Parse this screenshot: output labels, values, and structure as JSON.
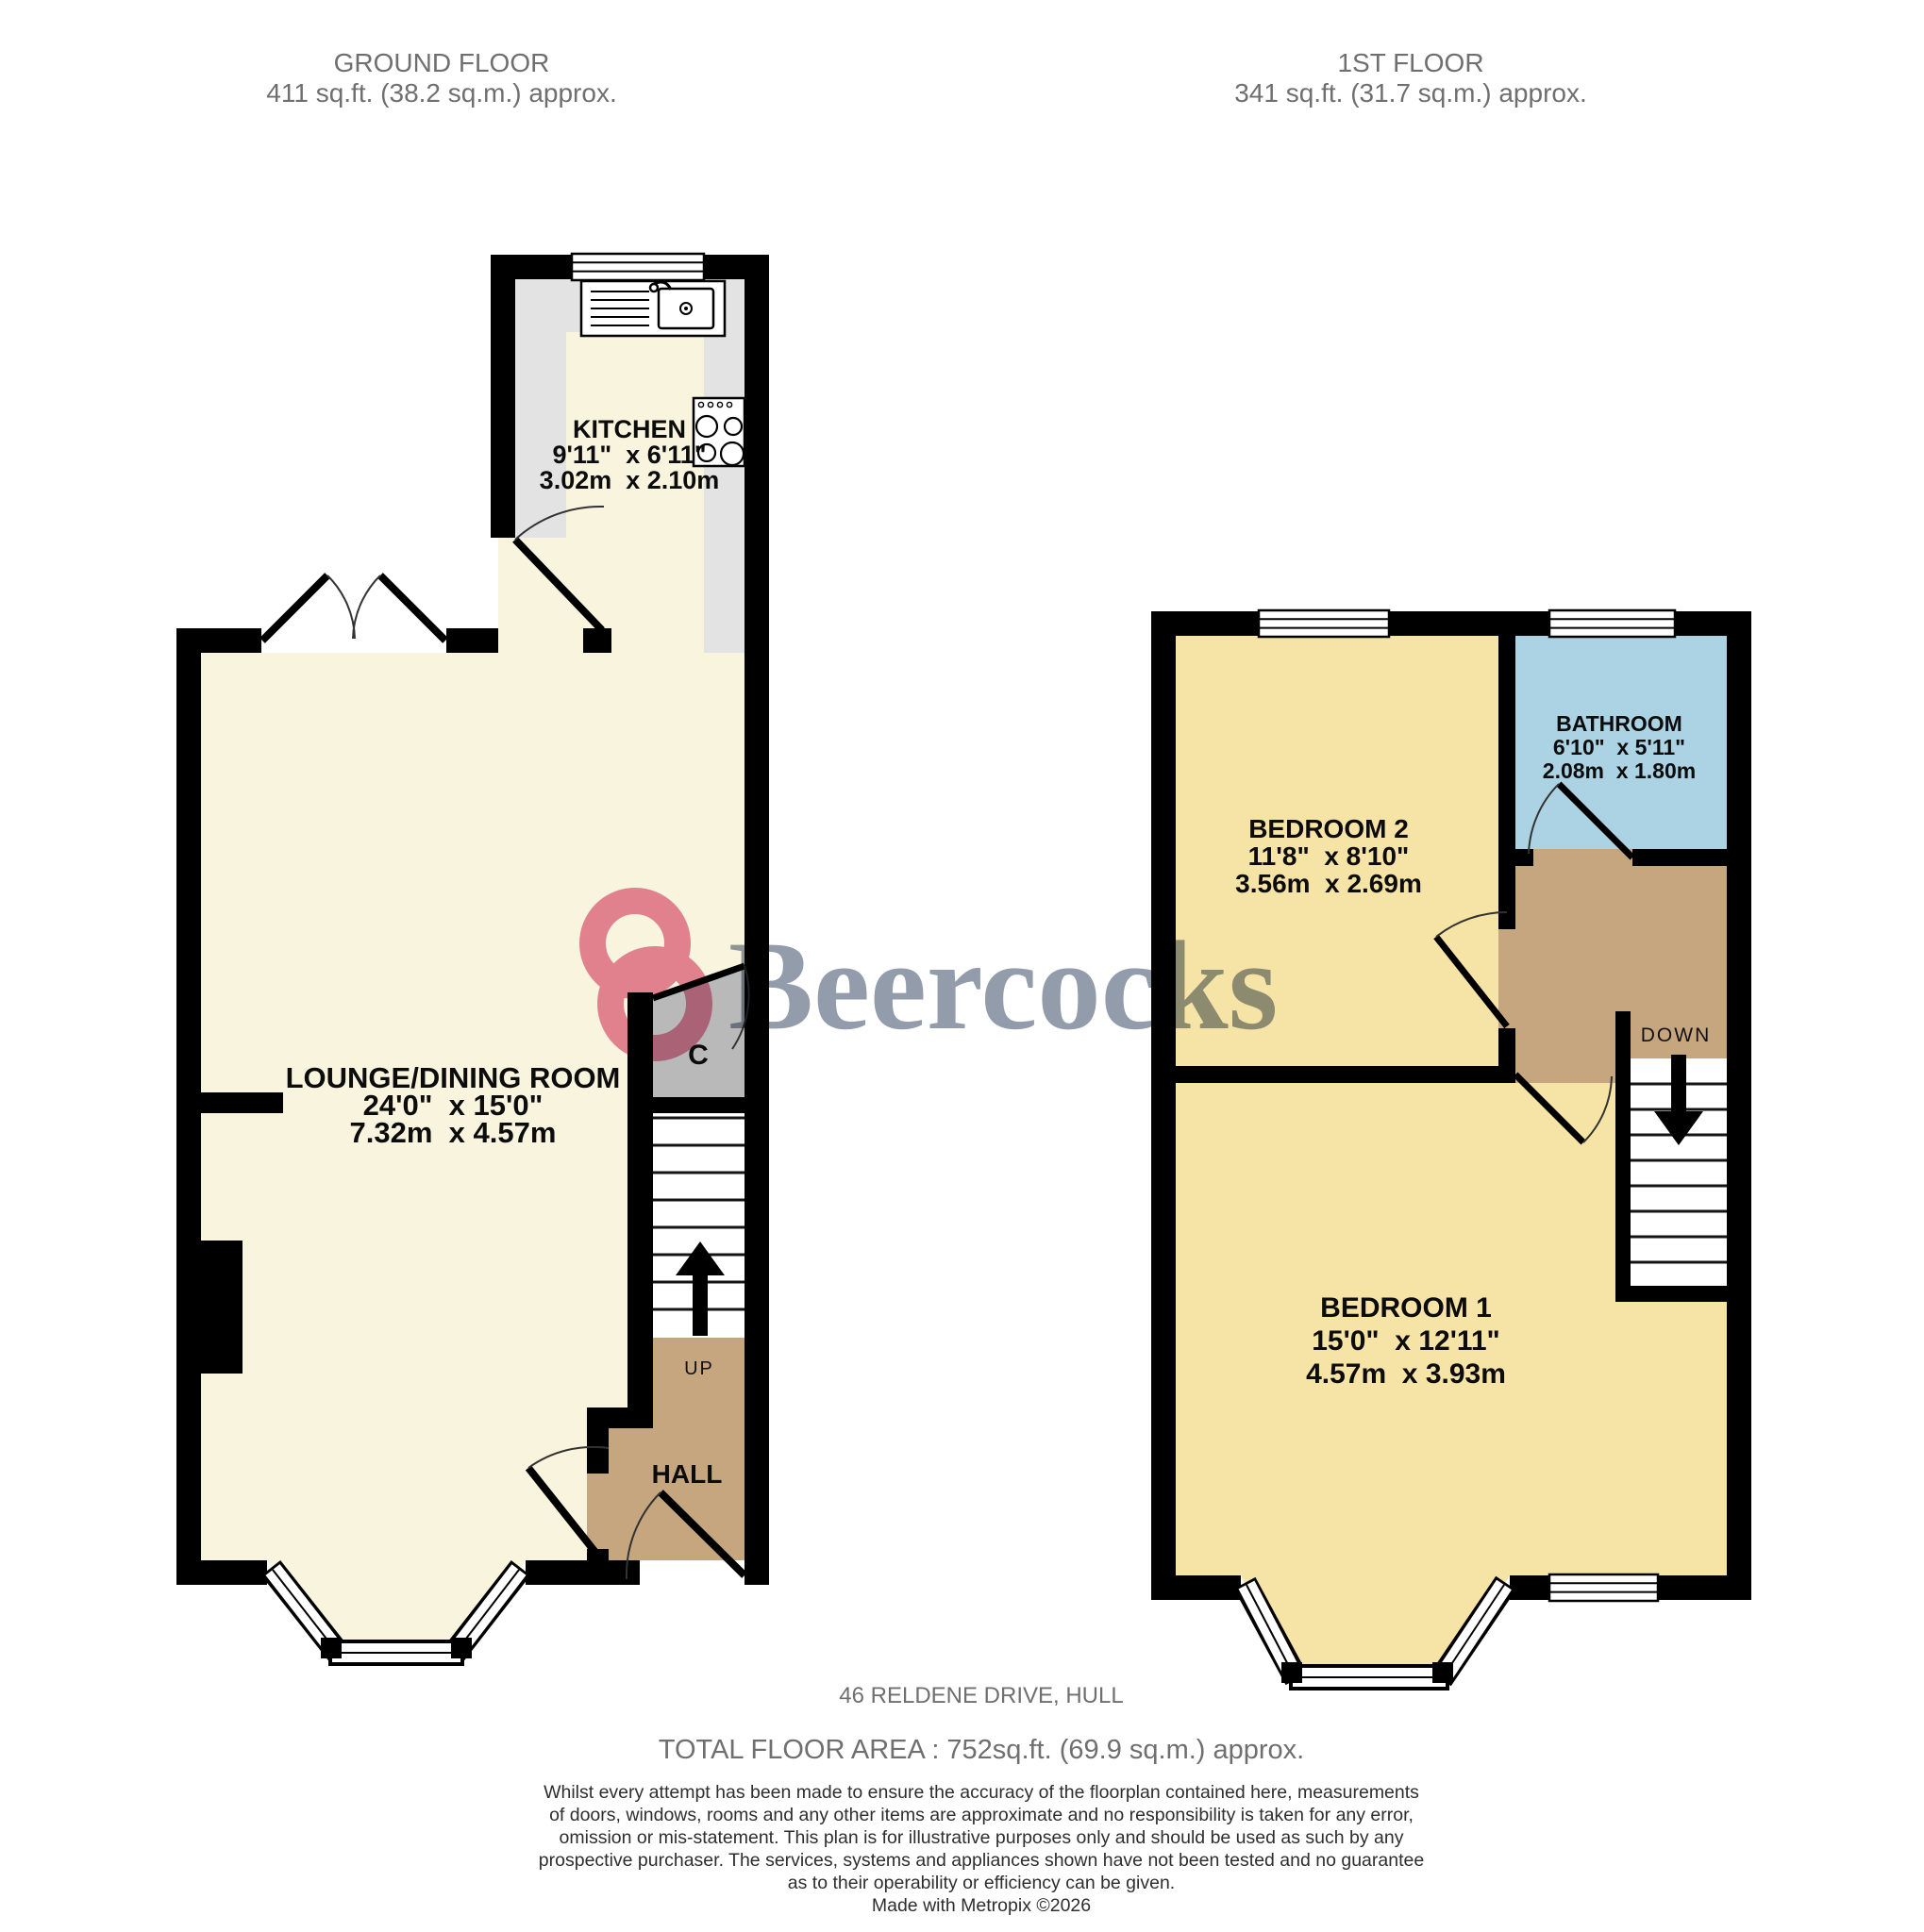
{
  "colors": {
    "floor_cream": "#f8f4de",
    "floor_yellow": "#f6e3a6",
    "bathroom_blue": "#abd3e3",
    "hall_tan": "#c5a67e",
    "cupboard_gray": "#b9b9b9",
    "counter_gray": "#e3e3e3",
    "wall_black": "#000000",
    "header_text": "#6f6f6f",
    "footer_text": "#6f6f6f",
    "disclaimer_text": "#2e2e2e",
    "watermark_pink": "#e8819e",
    "watermark_blue": "#8c97a7"
  },
  "ground_floor": {
    "title": "GROUND FLOOR",
    "area": "411 sq.ft. (38.2 sq.m.) approx.",
    "kitchen": {
      "name": "KITCHEN",
      "imperial": "9'11\"  x 6'11\"",
      "metric": "3.02m  x 2.10m"
    },
    "lounge": {
      "name": "LOUNGE/DINING ROOM",
      "imperial": "24'0\"  x 15'0\"",
      "metric": "7.32m  x 4.57m"
    },
    "hall": {
      "name": "HALL"
    },
    "cupboard_label": "C",
    "stairs_label": "UP"
  },
  "first_floor": {
    "title": "1ST FLOOR",
    "area": "341 sq.ft. (31.7 sq.m.) approx.",
    "bedroom2": {
      "name": "BEDROOM 2",
      "imperial": "11'8\"  x 8'10\"",
      "metric": "3.56m  x 2.69m"
    },
    "bathroom": {
      "name": "BATHROOM",
      "imperial": "6'10\"  x 5'11\"",
      "metric": "2.08m  x 1.80m"
    },
    "bedroom1": {
      "name": "BEDROOM 1",
      "imperial": "15'0\"  x 12'11\"",
      "metric": "4.57m  x 3.93m"
    },
    "stairs_label": "DOWN"
  },
  "watermark": {
    "brand": "Beercocks"
  },
  "footer": {
    "address": "46 RELDENE DRIVE, HULL",
    "total_area": "TOTAL FLOOR AREA : 752sq.ft. (69.9 sq.m.) approx.",
    "disclaimer_lines": [
      "Whilst every attempt has been made to ensure the accuracy of the floorplan contained here, measurements",
      "of doors, windows, rooms and any other items are approximate and no responsibility is taken for any error,",
      "omission or mis-statement. This plan is for illustrative purposes only and should be used as such by any",
      "prospective purchaser. The services, systems and appliances shown have not been tested and no guarantee",
      "as to their operability or efficiency can be given.",
      "Made with Metropix ©2026"
    ]
  }
}
